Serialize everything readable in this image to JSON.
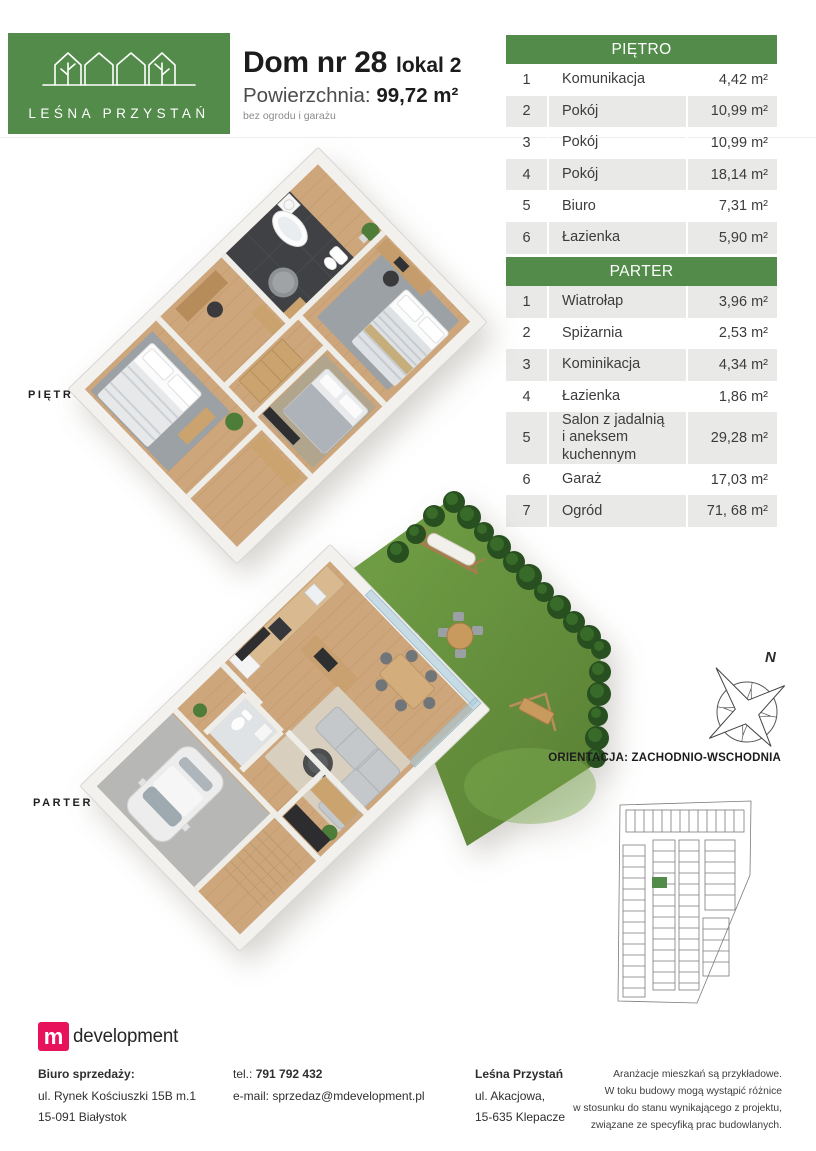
{
  "header": {
    "brand_name": "LEŚNA PRZYSTAŃ",
    "brand_color": "#538c4a",
    "title": "Dom nr 28",
    "title_suffix": "lokal 2",
    "area_label": "Powierzchnia: ",
    "area_value": "99,72 m²",
    "area_note": "bez ogrodu i garażu"
  },
  "tables": [
    {
      "title": "PIĘTRO",
      "rows": [
        {
          "no": "1",
          "name": "Komunikacja",
          "area": "4,42 m²"
        },
        {
          "no": "2",
          "name": "Pokój",
          "area": "10,99 m²"
        },
        {
          "no": "3",
          "name": "Pokój",
          "area": "10,99 m²"
        },
        {
          "no": "4",
          "name": "Pokój",
          "area": "18,14 m²"
        },
        {
          "no": "5",
          "name": "Biuro",
          "area": "7,31 m²"
        },
        {
          "no": "6",
          "name": "Łazienka",
          "area": "5,90 m²"
        }
      ]
    },
    {
      "title": "PARTER",
      "rows": [
        {
          "no": "1",
          "name": "Wiatrołap",
          "area": "3,96 m²"
        },
        {
          "no": "2",
          "name": "Spiżarnia",
          "area": "2,53 m²"
        },
        {
          "no": "3",
          "name": "Kominikacja",
          "area": "4,34 m²"
        },
        {
          "no": "4",
          "name": "Łazienka",
          "area": "1,86 m²"
        },
        {
          "no": "5",
          "name": "Salon z jadalnią\ni aneksem kuchennym",
          "area": "29,28 m²"
        },
        {
          "no": "6",
          "name": "Garaż",
          "area": "17,03 m²"
        },
        {
          "no": "7",
          "name": "Ogród",
          "area": "71, 68 m²"
        }
      ]
    }
  ],
  "plans": [
    {
      "label": "PIĘTRO"
    },
    {
      "label": "PARTER"
    }
  ],
  "compass": {
    "north_label": "N"
  },
  "orientation_text": "ORIENTACJA: ZACHODNIO-WSCHODNIA",
  "site_plan": {
    "highlight_color": "#538c4a"
  },
  "footer": {
    "developer_logo": {
      "mark": "m",
      "text": "development",
      "color": "#e8125c"
    },
    "office": {
      "title": "Biuro sprzedaży:",
      "line1": "ul. Rynek Kościuszki 15B m.1",
      "line2": "15-091 Białystok"
    },
    "contact": {
      "tel_label": "tel.: ",
      "tel": "791 792 432",
      "email_label": "e-mail: ",
      "email": "sprzedaz@mdevelopment.pl"
    },
    "estate": {
      "title": "Leśna Przystań",
      "line1": "ul. Akacjowa,",
      "line2": "15-635 Klepacze"
    },
    "disclaimer": [
      "Aranżacje mieszkań są przykładowe.",
      "W toku budowy mogą wystąpić różnice",
      "w stosunku do stanu wynikającego z projektu,",
      "związane ze specyfiką prac budowlanych."
    ]
  }
}
